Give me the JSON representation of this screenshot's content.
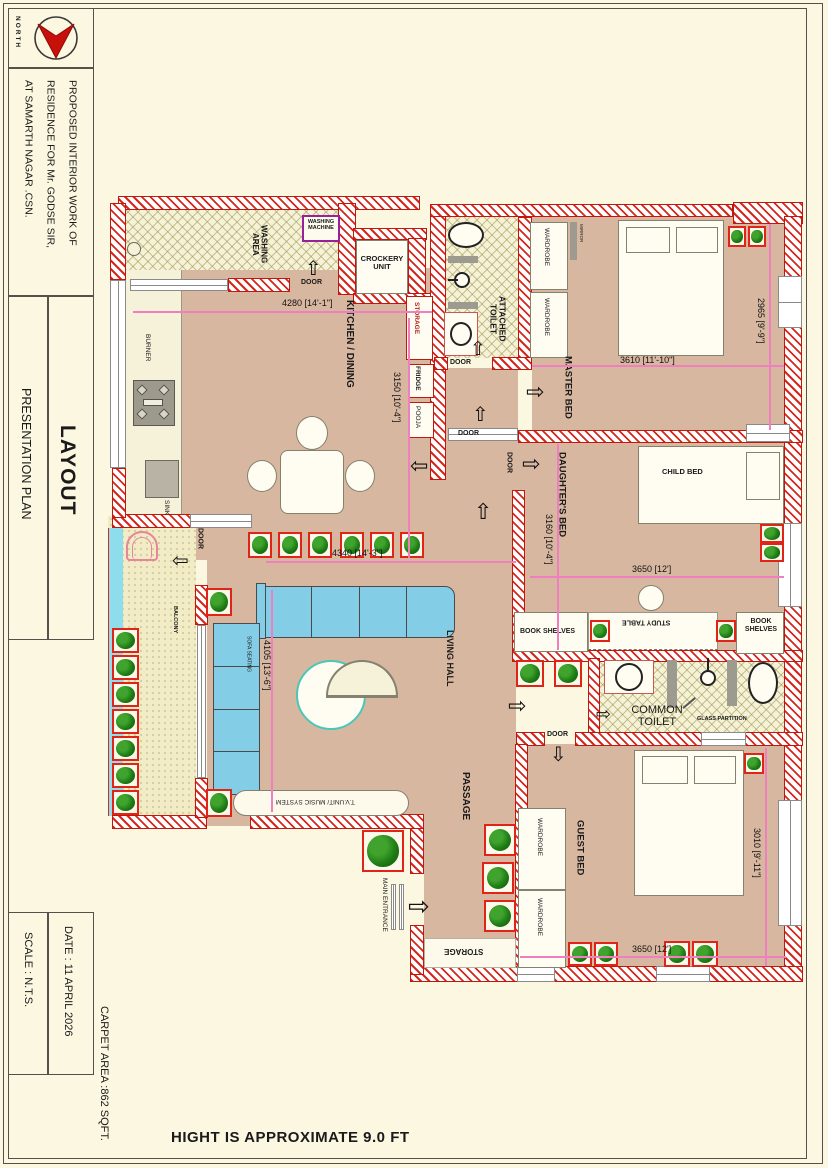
{
  "title_block": {
    "north_label": "NORTH",
    "project_title_lines": [
      "PROPOSED INTERIOR WORK OF",
      "RESIDENCE FOR Mr. GODSE SIR,",
      "AT SAMARTH NAGAR .CSN."
    ],
    "drawing_title": "LAYOUT",
    "drawing_subtitle": "PRESENTATION PLAN",
    "date": "DATE : 11 APRIL 2026",
    "scale": "SCALE : N.T.S.",
    "carpet_area": "CARPET AREA :862 SQFT.",
    "height_note": "HIGHT IS APPROXIMATE 9.0 FT"
  },
  "rooms": {
    "washing_area": "WASHING AREA",
    "kitchen_dining": "KITCHEN / DINING",
    "crockery_unit": "CROCKERY UNIT",
    "attached_toilet": "ATTACHED TOILET",
    "master_bed": "MASTER BED",
    "daughters_bed": "DAUGHTER'S BED",
    "living_hall": "LIVING HALL",
    "balcony": "BALCONY",
    "common_toilet": "COMMON TOILET",
    "guest_bed": "GUEST BED",
    "passage": "PASSAGE",
    "storage_room": "STORAGE",
    "main_entrance": "MAIN ENTRANCE"
  },
  "fixtures": {
    "washing_machine": "WASHING MACHINE",
    "burner": "BURNER",
    "sink": "SINK",
    "storage": "STORAGE",
    "fridge": "FRIDGE",
    "pooja": "POOJA",
    "wardrobe": "WARDROBE",
    "mirror": "MIRROR",
    "child_bed": "CHILD BED",
    "book_shelves": "BOOK SHELVES",
    "study_table": "STUDY TABLE",
    "sofa_seating": "SOFA SEATING",
    "tv_unit": "T.V.UNIT/ MUSIC SYSTEM",
    "glass_partition": "GLASS PARTITION",
    "door": "DOOR"
  },
  "dimensions": {
    "washing_width": "4280 [14'-1\"]",
    "kitchen_height": "3150 [10'-4\"]",
    "master_width": "3610 [11'-10\"]",
    "master_height": "2965 [9'-9\"]",
    "daughters_height": "3160 [10'-4\"]",
    "daughters_width": "3650 [12']",
    "living_width": "4340 [14'-3\"]",
    "living_height": "4105 [13'-6\"]",
    "guest_height": "3010 [9'-11\"]",
    "guest_width": "3650 [12']"
  },
  "colors": {
    "wall_red": "#d3281e",
    "floor_tan": "#d8b7a0",
    "sofa_blue": "#84cde6",
    "plant_green": "#1e7c14",
    "dim_pink": "#f07fc0",
    "washing_machine_purple": "#9b1f9b",
    "water_cyan": "#8edded",
    "page_cream": "#fbf7e0"
  }
}
